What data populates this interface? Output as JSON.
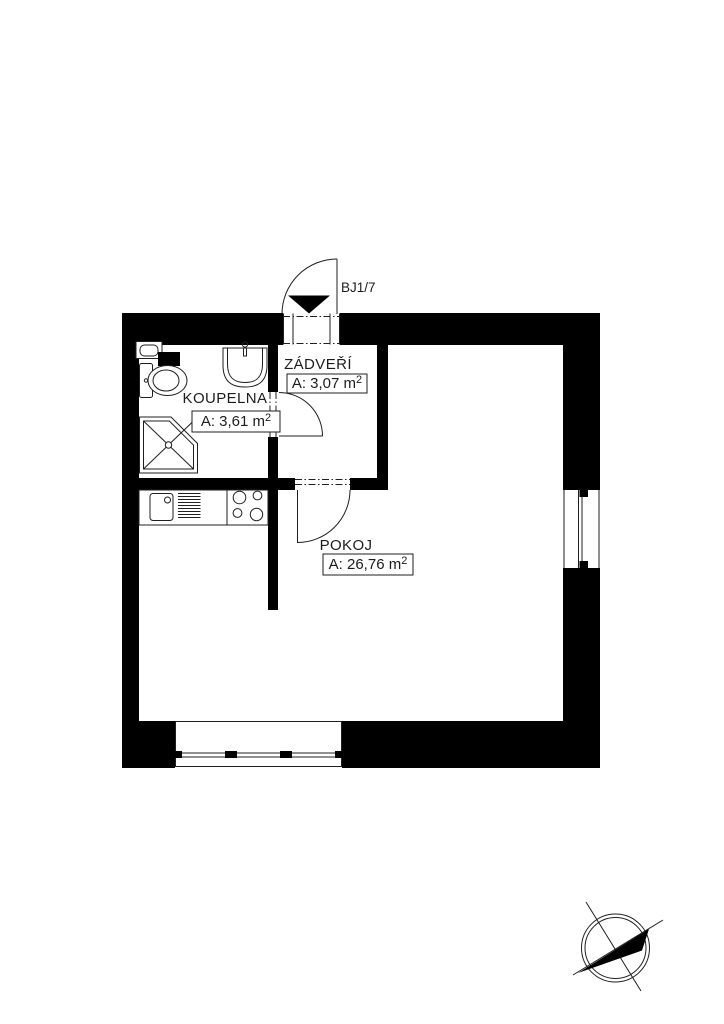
{
  "plan": {
    "unit_label": "BJ1/7",
    "rooms": {
      "zadveri": {
        "name": "ZÁDVEŘÍ",
        "area_label": "A: 3,07 m",
        "area_exponent": "2"
      },
      "koupelna": {
        "name": "KOUPELNA",
        "area_label": "A: 3,61 m",
        "area_exponent": "2"
      },
      "pokoj": {
        "name": "POKOJ",
        "area_label": "A: 26,76 m",
        "area_exponent": "2"
      }
    },
    "colors": {
      "wall": "#000000",
      "line": "#1f1f1f",
      "background": "#ffffff"
    }
  }
}
